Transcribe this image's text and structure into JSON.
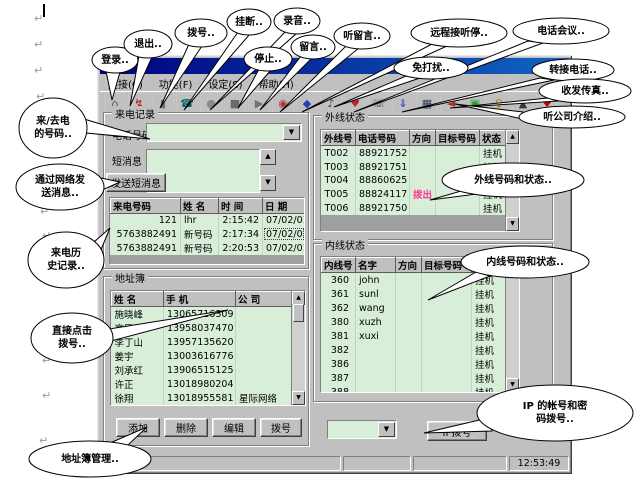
{
  "page": {
    "mark_glyph": "↵"
  },
  "window": {
    "menu_items": [
      "连接(C)",
      "功能(F)",
      "设定(S)",
      "帮助(H)"
    ],
    "toolbar_icons": [
      {
        "name": "home-icon",
        "glyph": "⌂",
        "color": "#505050"
      },
      {
        "name": "login-icon",
        "glyph": "↯",
        "color": "#c00000"
      },
      {
        "name": "logout-icon",
        "glyph": "▮",
        "color": "#707070"
      },
      {
        "name": "dial-icon",
        "glyph": "☎",
        "color": "#006868"
      },
      {
        "name": "hangup-icon",
        "glyph": "●",
        "color": "#8a8a8a"
      },
      {
        "name": "record-icon",
        "glyph": "■",
        "color": "#6a6a6a"
      },
      {
        "name": "play-icon",
        "glyph": "▶",
        "color": "#707070"
      },
      {
        "name": "ball-icon",
        "glyph": "◉",
        "color": "#b03030"
      },
      {
        "name": "message-icon",
        "glyph": "◆",
        "color": "#2040b0"
      },
      {
        "name": "listen-message-icon",
        "glyph": "♪",
        "color": "#404040"
      },
      {
        "name": "remote-listen-icon",
        "glyph": "♥",
        "color": "#c02020"
      },
      {
        "name": "phone2-icon",
        "glyph": "☏",
        "color": "#404040"
      },
      {
        "name": "download-icon",
        "glyph": "⇓",
        "color": "#2030c0"
      },
      {
        "name": "computer-icon",
        "glyph": "▦",
        "color": "#304060"
      },
      {
        "name": "speaker-icon",
        "glyph": "◄",
        "color": "#b03030"
      },
      {
        "name": "exit-door-icon",
        "glyph": "▣",
        "color": "#20a020"
      },
      {
        "name": "key-icon",
        "glyph": "♀",
        "color": "#a08000"
      },
      {
        "name": "tool-icon",
        "glyph": "▲",
        "color": "#383838"
      },
      {
        "name": "flag-icon",
        "glyph": "♥",
        "color": "#c00000"
      }
    ],
    "call_record": {
      "title": "来电记录",
      "phone_label": "电话号码",
      "sms_label": "短消息",
      "send_button": "发送短消息",
      "history_headers": [
        "来电号码",
        "姓  名",
        "时    间",
        "日    期"
      ],
      "history_rows": [
        [
          "121",
          "lhr",
          "2:15:42",
          "07/02/01"
        ],
        [
          "5763882491",
          "新号码",
          "2:17:34",
          "07/02/01"
        ],
        [
          "5763882491",
          "新号码",
          "2:20:53",
          "07/02/01"
        ]
      ]
    },
    "ext_status": {
      "title": "外线状态",
      "headers": [
        "外线号",
        "电话号码",
        "方向",
        "目标号码",
        "状态"
      ],
      "rows": [
        [
          "T002",
          "88921752",
          "",
          "",
          "挂机"
        ],
        [
          "T003",
          "88921751",
          "",
          "",
          "挂机"
        ],
        [
          "T004",
          "88860625",
          "",
          "",
          ""
        ],
        [
          "T005",
          "88824117",
          "拨出",
          "",
          "挂机"
        ],
        [
          "T006",
          "88921750",
          "",
          "",
          "挂机"
        ]
      ]
    },
    "int_status": {
      "title": "内线状态",
      "headers": [
        "内线号",
        "名字",
        "方向",
        "目标号码",
        "状态"
      ],
      "rows": [
        [
          "360",
          "john",
          "",
          "",
          "挂机"
        ],
        [
          "361",
          "sunl",
          "",
          "",
          "挂机"
        ],
        [
          "362",
          "wang",
          "",
          "",
          "挂机"
        ],
        [
          "380",
          "xuzh",
          "",
          "",
          "挂机"
        ],
        [
          "381",
          "xuxi",
          "",
          "",
          "挂机"
        ],
        [
          "382",
          "",
          "",
          "",
          "挂机"
        ],
        [
          "386",
          "",
          "",
          "",
          "挂机"
        ],
        [
          "387",
          "",
          "",
          "",
          "挂机"
        ],
        [
          "388",
          "",
          "",
          "",
          "挂机"
        ]
      ]
    },
    "address_book": {
      "title": "地址簿",
      "headers": [
        "姓  名",
        "手  机",
        "公  司"
      ],
      "rows": [
        [
          "施晓峰",
          "13065716309",
          ""
        ],
        [
          "高民",
          "13958037470",
          ""
        ],
        [
          "李丁山",
          "13957135620",
          ""
        ],
        [
          "姜宇",
          "13003616776",
          ""
        ],
        [
          "刘承红",
          "13906515125",
          ""
        ],
        [
          "许正",
          "13018980204",
          ""
        ],
        [
          "徐翔",
          "13018955581",
          "星际网络"
        ]
      ],
      "buttons": [
        "添加",
        "删除",
        "编辑",
        "拨号"
      ]
    },
    "ip_button": "IP拨号",
    "status_time": "12:53:49"
  },
  "callouts": {
    "login": "登录..",
    "exit": "退出..",
    "dial": "拨号..",
    "hangup": "挂断..",
    "record": "录音..",
    "stop": "停止..",
    "message": "留言..",
    "listen_message": "听留言..",
    "remote_listen": "远程接听停..",
    "conference": "电话会议..",
    "dnd": "免打扰..",
    "transfer": "转接电话..",
    "fax": "收发传真..",
    "company_intro": "听公司介绍..",
    "inout_number": "来/去电\n的号码..",
    "net_message": "通过网络发\n送消息..",
    "call_history": "来电历\n史记录..",
    "click_dial": "直接点击\n拨号..",
    "addr_mgmt": "地址簿管理..",
    "ext_status": "外线号码和状态..",
    "int_status": "内线号码和状态..",
    "ip_dial": "IP 的帐号和密\n码拨号.."
  }
}
